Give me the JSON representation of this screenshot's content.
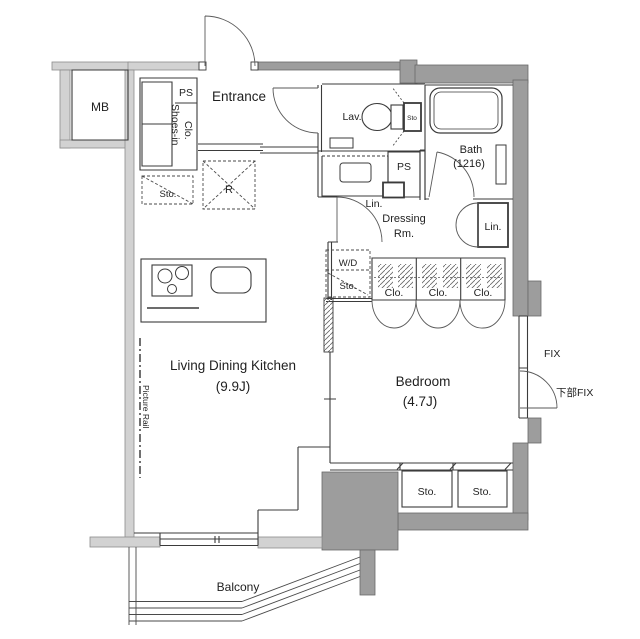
{
  "plan": {
    "type": "apartment-floor-plan",
    "colors": {
      "wall_dark": "#9d9d9d",
      "wall_light": "#d2d2d2",
      "line": "#3b3b3b",
      "background": "#ffffff"
    },
    "rooms": [
      {
        "name": "Living Dining Kitchen",
        "size": "9.9J"
      },
      {
        "name": "Bedroom",
        "size": "4.7J"
      },
      {
        "name": "Bath",
        "size": "1216"
      },
      {
        "name": "Entrance"
      },
      {
        "name": "Lavatory"
      },
      {
        "name": "Dressing Room"
      },
      {
        "name": "Balcony"
      }
    ]
  },
  "labels": {
    "mb": "MB",
    "ps_top": "PS",
    "entrance": "Entrance",
    "shoes_in_1": "Shoes-in",
    "shoes_in_2": "Clo.",
    "kitchen_sto": "Sto.",
    "refrigerator": "R",
    "lav": "Lav.",
    "lav_sto": "Sto",
    "bath_1": "Bath",
    "bath_2": "(1216)",
    "ps_mid": "PS",
    "lin_mid": "Lin.",
    "dressing_1": "Dressing",
    "dressing_2": "Rm.",
    "lin_right": "Lin.",
    "wd": "W/D",
    "wd_sto": "Sto.",
    "clo_1": "Clo.",
    "clo_2": "Clo.",
    "clo_3": "Clo.",
    "ldk_1": "Living Dining Kitchen",
    "ldk_2": "(9.9J)",
    "picture_rail": "Picture Rail",
    "bedroom_1": "Bedroom",
    "bedroom_2": "(4.7J)",
    "fix": "FIX",
    "lower_fix": "下部FIX",
    "bedroom_sto_1": "Sto.",
    "bedroom_sto_2": "Sto.",
    "balcony": "Balcony"
  }
}
